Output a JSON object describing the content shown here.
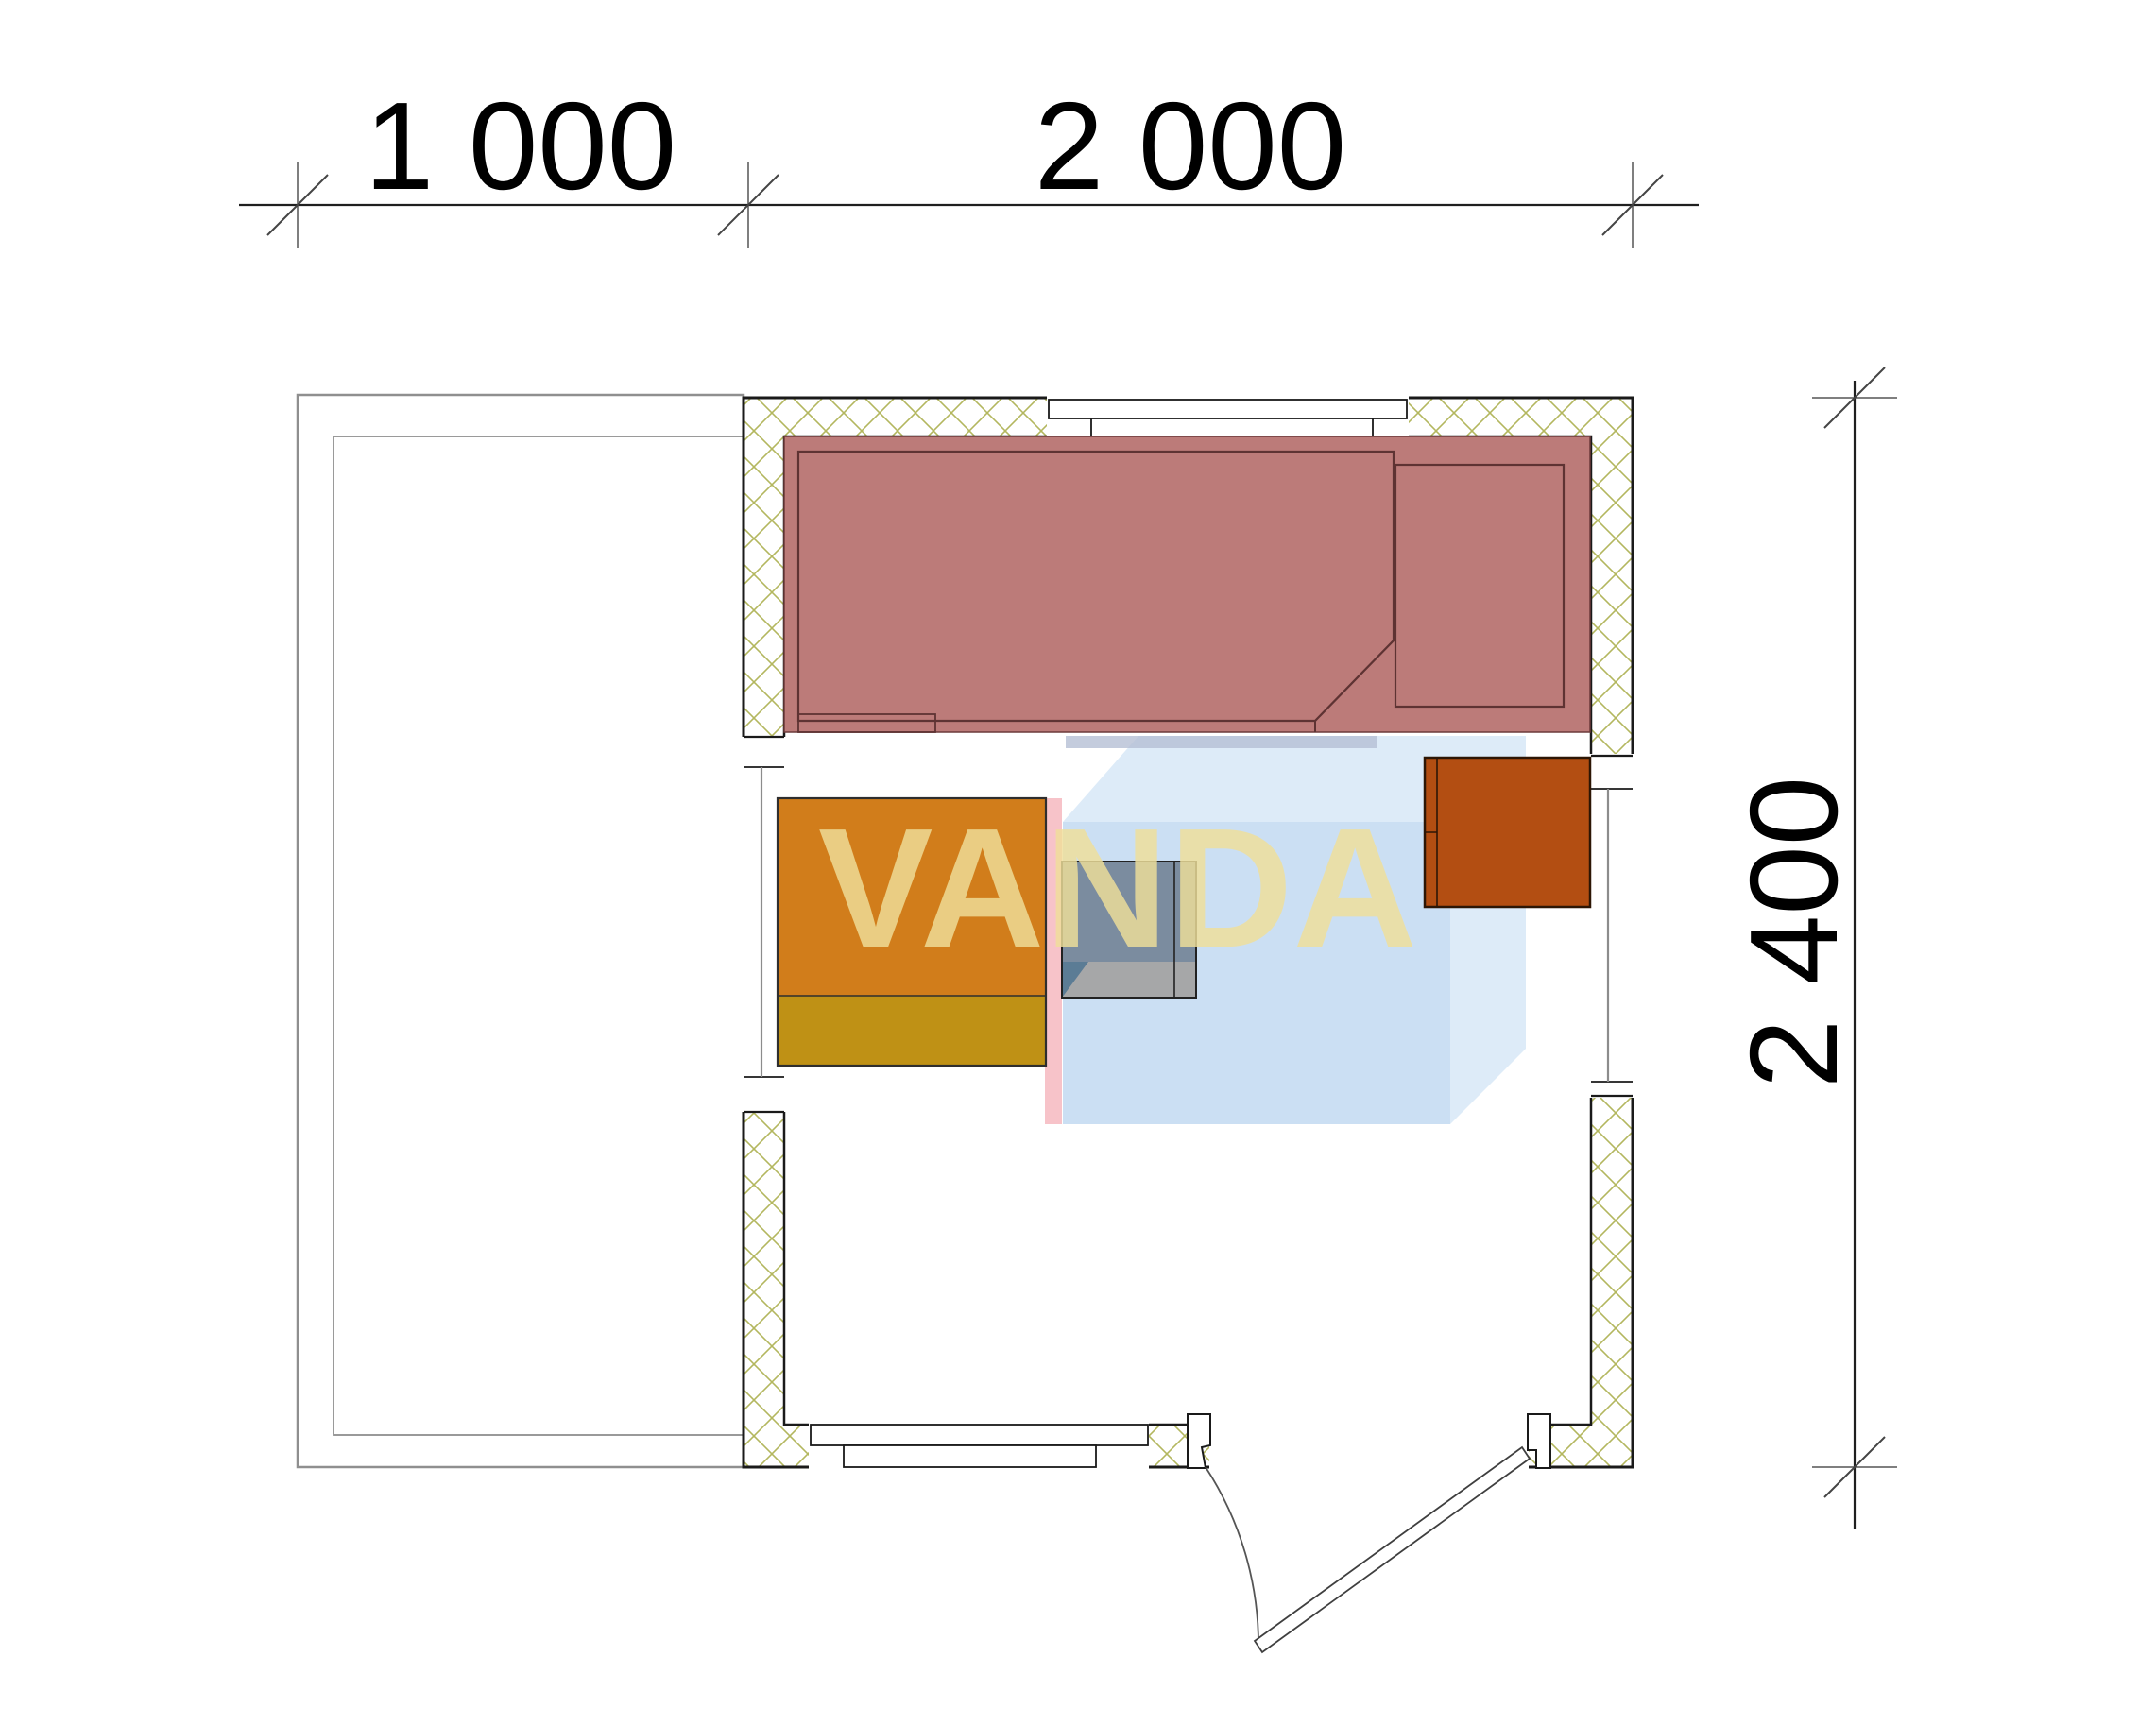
{
  "dimensions": {
    "top_left": {
      "label": "1 000"
    },
    "top_right": {
      "label": "2 000"
    },
    "right": {
      "label": "2 400"
    }
  },
  "watermark": {
    "text": "VANDA"
  },
  "colors": {
    "hatch": "#b3b75e",
    "wall_line": "#1a1a1a",
    "terrace_line": "#8f8f8f",
    "glass_line": "#8c8c8c",
    "bench_fill": "#bc7b79",
    "bench_line": "#5e3333",
    "table_top": "#d17d1b",
    "table_base": "#bf9115",
    "table_line": "#2e2e2e",
    "stove_body": "#6f8193",
    "stove_front": "#a9a9a9",
    "stove_corner": "#587a93",
    "heater_fill": "#b34e12",
    "heater_line": "#2d1605",
    "logo_blue_outer": "#d7e7f7",
    "logo_blue_inner": "#c9def2",
    "logo_blue_band": "#b5bfd4",
    "logo_pink": "#f6bcc3",
    "watermark_text_fill": "#f0df9a",
    "dim_line": "#1f1f1f",
    "dim_tick": "#444444",
    "dim_witness": "#555555"
  }
}
